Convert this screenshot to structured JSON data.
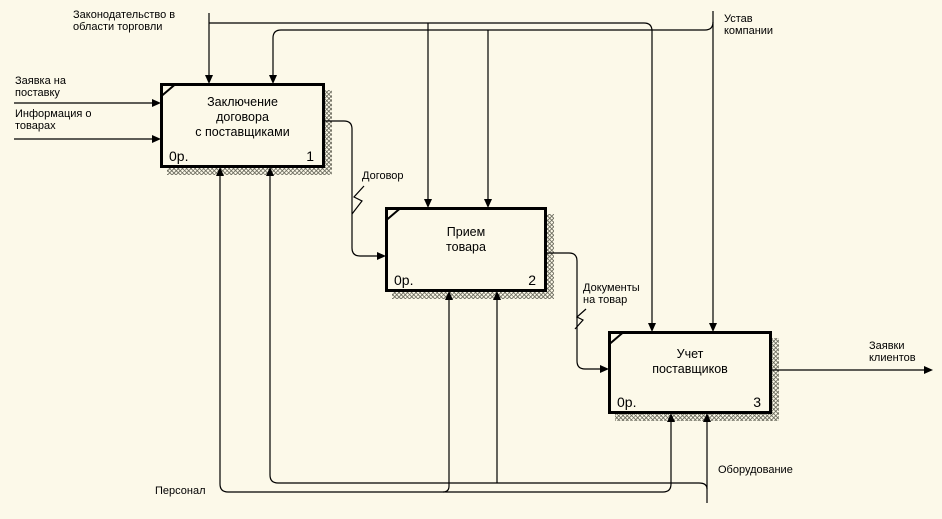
{
  "canvas": {
    "background": "#fcf9e9",
    "line_color": "#000000"
  },
  "boxes": [
    {
      "title_lines": [
        "Заключение",
        "договора",
        "с поставщиками"
      ],
      "cost": "0р.",
      "number": "1"
    },
    {
      "title_lines": [
        "Прием",
        "товара"
      ],
      "cost": "0р.",
      "number": "2"
    },
    {
      "title_lines": [
        "Учет",
        "поставщиков"
      ],
      "cost": "0р.",
      "number": "3"
    }
  ],
  "labels": {
    "legislation": [
      "Законодательство в",
      "области торговли"
    ],
    "charter": [
      "Устав",
      "компании"
    ],
    "supply_request": [
      "Заявка на",
      "поставку"
    ],
    "product_info": [
      "Информация о",
      "товарах"
    ],
    "contract": [
      "Договор"
    ],
    "goods_documents": [
      "Документы",
      "на товар"
    ],
    "client_requests": [
      "Заявки",
      "клиентов"
    ],
    "personnel": [
      "Персонал"
    ],
    "equipment": [
      "Оборудование"
    ]
  }
}
